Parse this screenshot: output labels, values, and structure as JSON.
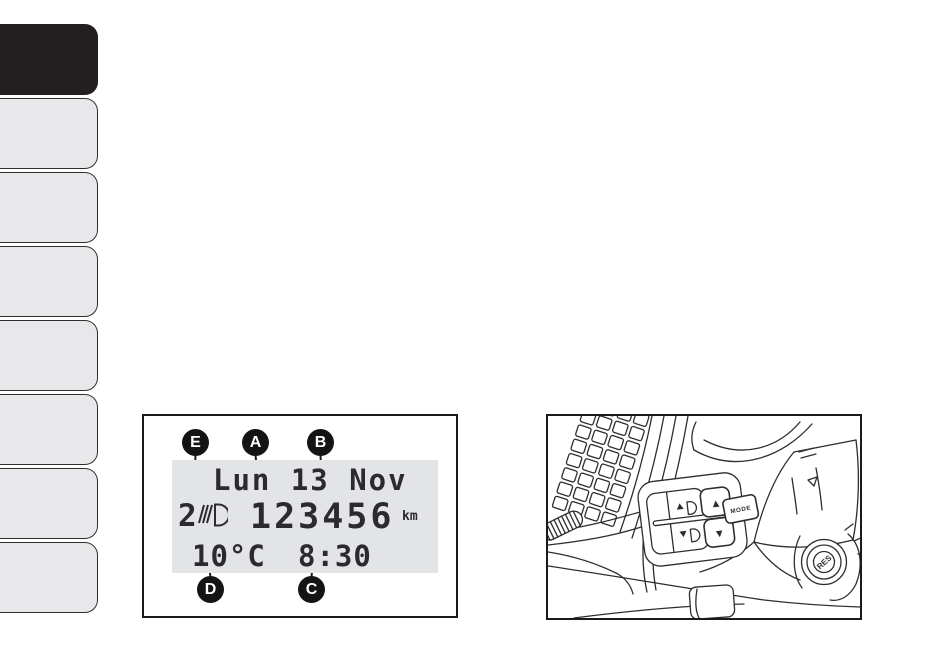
{
  "page": {
    "background": "#ffffff",
    "ink": "#2b2b2e",
    "tab_active_color": "#231f20",
    "tab_inactive_color": "#e8e8ea",
    "screen_bg": "#e3e4e6"
  },
  "sidebar": {
    "tab_count": 8,
    "active_tab_index": 0
  },
  "display_figure": {
    "callouts": {
      "top": [
        "E",
        "A",
        "B"
      ],
      "bottom": [
        "D",
        "C"
      ]
    },
    "screen": {
      "date_line": "Lun 13 Nov",
      "headlight_level": "2",
      "leveling_icon": "headlight-leveling-icon",
      "odometer": "123456",
      "odometer_unit": "km",
      "temperature": "10°C",
      "time": "8:30"
    }
  },
  "controls_figure": {
    "up_arrow": "▲",
    "down_arrow": "▼",
    "mode_label": "MODE",
    "res_label": "RES",
    "icons": {
      "raise_headlight": "headlight-beam-raise-icon",
      "lower_headlight": "headlight-beam-lower-icon",
      "vent": "air-vent-grille",
      "thumbwheel": "dimmer-thumbwheel",
      "knob": "res-knob"
    }
  }
}
